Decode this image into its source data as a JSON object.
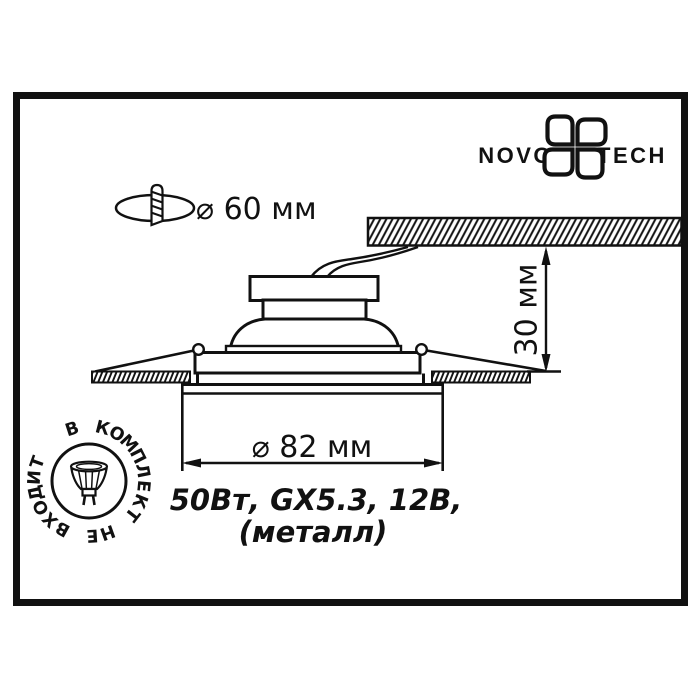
{
  "window": {
    "background": "#ffffff",
    "ink": "#111111"
  },
  "brand": {
    "left": "NOVO",
    "right": "TECH"
  },
  "callouts": {
    "cutout_diameter": "⌀ 60 мм",
    "recess_depth": "30 мм",
    "outer_diameter": "⌀ 82 мм"
  },
  "specs": {
    "line1": "50Вт, GX5.3, 12В,",
    "line2": "(металл)"
  },
  "stamp": {
    "text": "В КОМПЛЕКТ НЕ ВХОДИТ"
  }
}
